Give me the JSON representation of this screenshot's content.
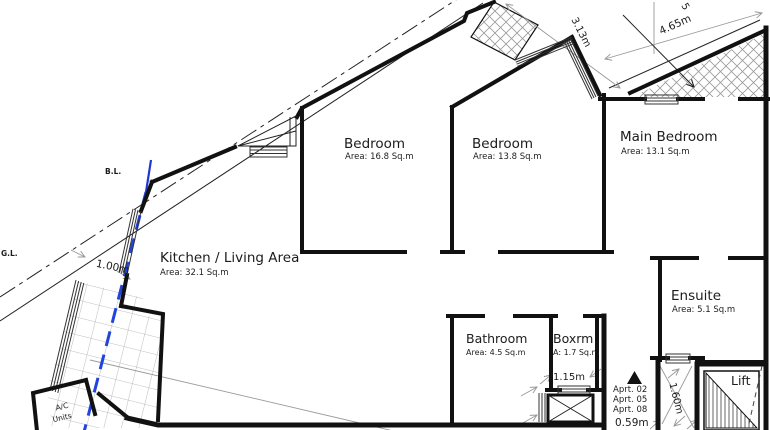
{
  "drawing_title": "apartment-floor-plan",
  "colors": {
    "wall": "#111111",
    "thin_line": "#222222",
    "dimension_gray": "#999999",
    "boundary_blue": "#2236cf",
    "background": "#ffffff"
  },
  "rooms": [
    {
      "name": "Kitchen / Living Area",
      "area": "Area: 32.1 Sq.m"
    },
    {
      "name": "Bedroom",
      "area": "Area: 16.8 Sq.m"
    },
    {
      "name": "Bedroom",
      "area": "Area: 13.8 Sq.m"
    },
    {
      "name": "Main Bedroom",
      "area": "Area: 13.1 Sq.m"
    },
    {
      "name": "Ensuite",
      "area": "Area: 5.1 Sq.m"
    },
    {
      "name": "Bathroom",
      "area": "Area: 4.5 Sq.m"
    },
    {
      "name": "Boxrm",
      "area": "A: 1.7 Sq.m"
    },
    {
      "name": "Lift",
      "area": ""
    }
  ],
  "dimensions": {
    "d313": "3.13m",
    "d465": "4.65m",
    "d100": "1.00m",
    "d115": "1.15m",
    "d059": "0.59m",
    "d160": "1.60m",
    "partial": "5"
  },
  "annotations": {
    "bl": "B.L.",
    "gl": "G.L.",
    "ac_line1": "A/C",
    "ac_line2": "Units",
    "apt1": "Aprt. 02",
    "apt2": "Aprt. 05",
    "apt3": "Aprt. 08"
  }
}
